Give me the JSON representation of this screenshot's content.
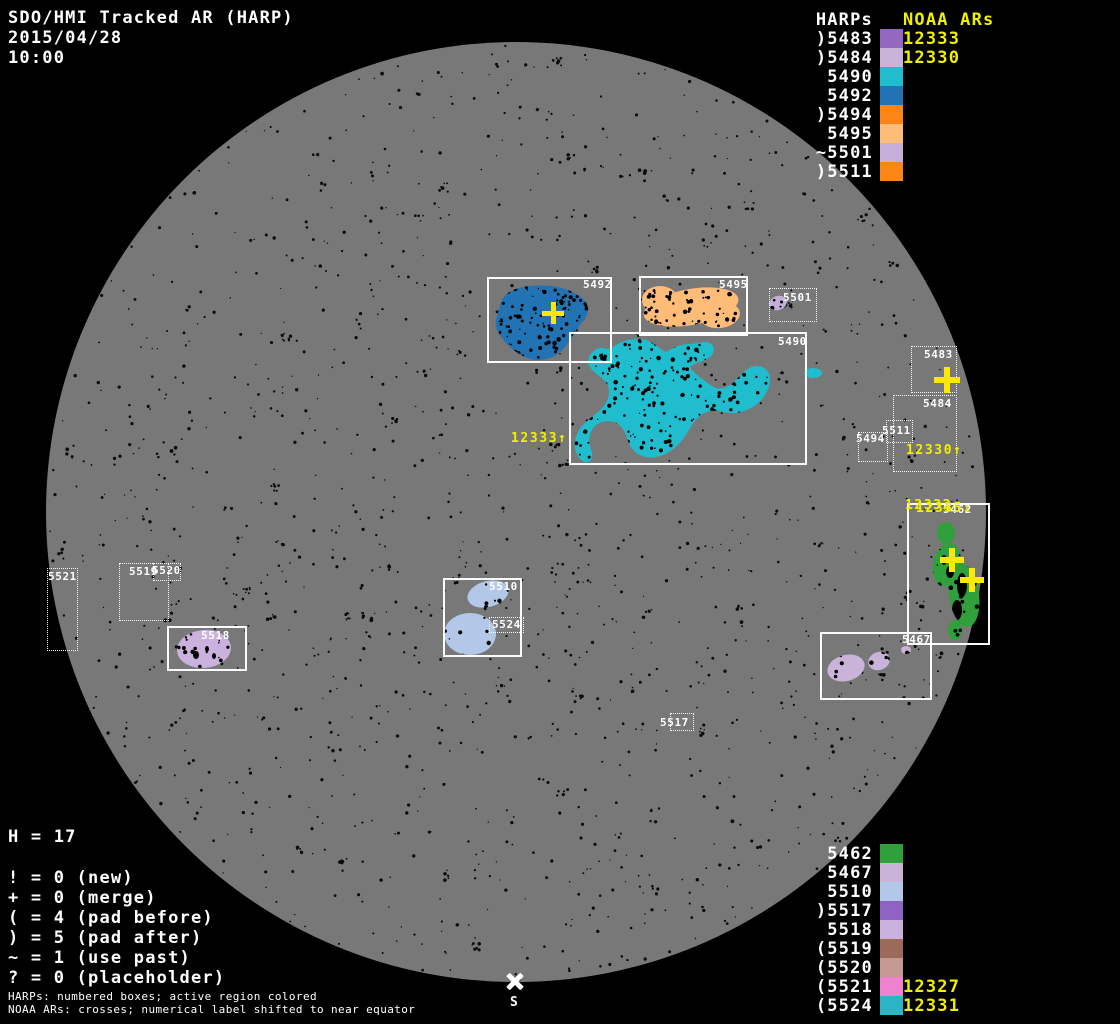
{
  "header": {
    "title": "SDO/HMI Tracked AR (HARP)",
    "date": "2015/04/28",
    "time": "10:00"
  },
  "colors": {
    "background": "#000000",
    "disk": "#787878",
    "speckle": "#0b0b0b",
    "box_border": "#ffffff",
    "white_text": "#ffffff",
    "yellow_text": "#f0f000",
    "cross_yellow": "#ffe70a"
  },
  "legend_top": {
    "noaa_header": "NOAA ARs",
    "harps_header": "HARPs",
    "rows": [
      {
        "noaa": "12333",
        "harp": ")5483",
        "color": "#9468BE"
      },
      {
        "noaa": "12330",
        "harp": ")5484",
        "color": "#C9B3D9"
      },
      {
        "harp": "5490",
        "color": "#1FBDCE"
      },
      {
        "harp": "5492",
        "color": "#2173B4"
      },
      {
        "harp": ")5494",
        "color": "#FB8617"
      },
      {
        "harp": "5495",
        "color": "#FFBB78"
      },
      {
        "harp": "~5501",
        "color": "#C4AFD9"
      },
      {
        "harp": ")5511",
        "color": "#FB8617"
      }
    ]
  },
  "legend_bottom": {
    "rows": [
      {
        "harp": "5462",
        "color": "#2FA03C"
      },
      {
        "harp": "5467",
        "color": "#C9B3D9"
      },
      {
        "harp": "5510",
        "color": "#B3C8E8"
      },
      {
        "harp": ")5517",
        "color": "#8F63C4"
      },
      {
        "harp": "5518",
        "color": "#CBB2DE"
      },
      {
        "harp": "(5519",
        "color": "#9C6A58"
      },
      {
        "harp": "(5520",
        "color": "#C59A92"
      },
      {
        "noaa": "12327",
        "harp": "(5521",
        "color": "#EE82CE"
      },
      {
        "noaa": "12331",
        "harp": "(5524",
        "color": "#2AB6C5"
      }
    ]
  },
  "stats": {
    "h_line": "H = 17",
    "lines": [
      "! = 0 (new)",
      "+ = 0 (merge)",
      "( = 4 (pad before)",
      ") = 5 (pad after)",
      "~ = 1 (use past)",
      "? = 0 (placeholder)"
    ]
  },
  "footnotes": {
    "line1": "HARPs: numbered boxes; active region colored",
    "line2": "NOAA ARs: crosses; numerical label shifted to near equator"
  },
  "south_marker": {
    "label": "S",
    "x": 515,
    "y": 981
  },
  "disk": {
    "cx": 516,
    "cy": 512,
    "r": 470
  },
  "boxes": [
    {
      "id": "5492",
      "x": 487,
      "y": 277,
      "w": 125,
      "h": 86,
      "style": "solid",
      "label": "5492",
      "lx": 583,
      "ly": 278
    },
    {
      "id": "5495",
      "x": 639,
      "y": 276,
      "w": 109,
      "h": 60,
      "style": "solid",
      "label": "5495",
      "lx": 719,
      "ly": 278
    },
    {
      "id": "5490",
      "x": 569,
      "y": 332,
      "w": 238,
      "h": 133,
      "style": "solid",
      "label": "5490",
      "lx": 778,
      "ly": 335
    },
    {
      "id": "5462",
      "x": 907,
      "y": 503,
      "w": 83,
      "h": 142,
      "style": "solid",
      "label": "5462",
      "lx": 943,
      "ly": 503
    },
    {
      "id": "5467",
      "x": 820,
      "y": 632,
      "w": 112,
      "h": 68,
      "style": "solid",
      "label": "5467",
      "lx": 902,
      "ly": 633
    },
    {
      "id": "5518",
      "x": 167,
      "y": 626,
      "w": 80,
      "h": 45,
      "style": "solid",
      "label": "5518",
      "lx": 201,
      "ly": 629
    },
    {
      "id": "5510",
      "x": 443,
      "y": 578,
      "w": 79,
      "h": 79,
      "style": "solid",
      "label": "5510",
      "lx": 489,
      "ly": 580
    },
    {
      "id": "5501",
      "x": 769,
      "y": 288,
      "w": 48,
      "h": 34,
      "style": "dashed",
      "label": "5501",
      "lx": 783,
      "ly": 291
    },
    {
      "id": "5483",
      "x": 911,
      "y": 346,
      "w": 46,
      "h": 47,
      "style": "dashed",
      "label": "5483",
      "lx": 924,
      "ly": 348
    },
    {
      "id": "5484",
      "x": 893,
      "y": 395,
      "w": 64,
      "h": 77,
      "style": "dashed",
      "label": "5484",
      "lx": 923,
      "ly": 397
    },
    {
      "id": "5511",
      "x": 886,
      "y": 420,
      "w": 27,
      "h": 23,
      "style": "dashed",
      "label": "5511",
      "lx": 882,
      "ly": 424
    },
    {
      "id": "5494",
      "x": 858,
      "y": 432,
      "w": 30,
      "h": 30,
      "style": "dashed",
      "label": "5494",
      "lx": 856,
      "ly": 432
    },
    {
      "id": "5521",
      "x": 47,
      "y": 568,
      "w": 31,
      "h": 83,
      "style": "dashed",
      "label": "5521",
      "lx": 48,
      "ly": 570
    },
    {
      "id": "5519",
      "x": 119,
      "y": 563,
      "w": 50,
      "h": 58,
      "style": "dashed",
      "label": "5519",
      "lx": 129,
      "ly": 565
    },
    {
      "id": "5520",
      "x": 153,
      "y": 563,
      "w": 28,
      "h": 18,
      "style": "dashed",
      "label": "5520",
      "lx": 152,
      "ly": 564
    },
    {
      "id": "5517",
      "x": 670,
      "y": 713,
      "w": 24,
      "h": 18,
      "style": "dashed",
      "label": "5517",
      "lx": 660,
      "ly": 716
    },
    {
      "id": "5524",
      "x": 489,
      "y": 617,
      "w": 35,
      "h": 16,
      "style": "dashed",
      "label": "5524",
      "lx": 492,
      "ly": 618
    }
  ],
  "disk_labels": [
    {
      "text": "12333↑",
      "x": 511,
      "y": 431
    },
    {
      "text": "12330↑",
      "x": 906,
      "y": 443
    },
    {
      "text": "12332",
      "x": 905,
      "y": 498
    },
    {
      "text": "12335↓",
      "x": 916,
      "y": 501
    }
  ],
  "crosses": [
    {
      "x": 553,
      "y": 313,
      "s": 22,
      "t": 5
    },
    {
      "x": 947,
      "y": 380,
      "s": 26,
      "t": 6
    },
    {
      "x": 952,
      "y": 560,
      "s": 24,
      "t": 6
    },
    {
      "x": 972,
      "y": 580,
      "s": 24,
      "t": 6
    }
  ],
  "regions": [
    {
      "id": "5492",
      "color": "#2173B4",
      "speckles": 130,
      "bbox": [
        492,
        286,
        100,
        74
      ],
      "shapes": [
        {
          "type": "path",
          "d": "M 500 305 C 502 295 512 289 523 287 C 538 284 555 285 568 290 C 578 294 587 300 588 308 C 589 316 582 322 577 329 C 570 339 566 349 556 355 C 546 361 533 362 523 356 C 512 350 502 341 497 330 C 493 322 499 313 500 305 Z"
        }
      ]
    },
    {
      "id": "5495",
      "color": "#FFBB78",
      "speckles": 70,
      "bbox": [
        645,
        288,
        95,
        40
      ],
      "shapes": [
        {
          "type": "ellipse",
          "cx": 691,
          "cy": 307,
          "rx": 48,
          "ry": 18,
          "rot": -10
        },
        {
          "type": "ellipse",
          "cx": 660,
          "cy": 300,
          "rx": 18,
          "ry": 14,
          "rot": 0
        },
        {
          "type": "ellipse",
          "cx": 720,
          "cy": 315,
          "rx": 20,
          "ry": 13,
          "rot": -8
        }
      ]
    },
    {
      "id": "5501",
      "color": "#C4AFD9",
      "speckles": 5,
      "bbox": [
        769,
        295,
        20,
        16
      ],
      "shapes": [
        {
          "type": "ellipse",
          "cx": 778,
          "cy": 303,
          "rx": 9,
          "ry": 7,
          "rot": -20
        }
      ]
    },
    {
      "id": "5490",
      "color": "#1FBDCE",
      "speckles": 300,
      "bbox": [
        575,
        340,
        200,
        122
      ],
      "shapes": [
        {
          "type": "path",
          "d": "M 612 348 C 620 341 634 337 646 340 C 654 342 659 349 666 352 C 674 347 682 344 690 344 C 697 344 704 340 710 343 C 715 346 715 353 710 357 C 704 362 695 362 690 367 C 695 375 704 380 712 386 C 719 391 727 388 734 382 C 741 375 748 366 757 366 C 765 366 771 373 770 381 C 769 392 762 401 753 407 C 744 412 733 415 724 412 C 716 410 708 410 701 415 C 693 421 689 431 683 439 C 676 448 667 455 656 457 C 646 459 636 455 631 447 C 626 439 626 429 618 424 C 610 419 600 421 594 427 C 589 433 588 442 591 449 C 593 455 593 461 588 462 C 583 463 578 458 576 452 C 573 443 576 433 582 426 C 588 419 597 414 603 407 C 609 400 611 391 607 384 C 603 377 594 374 590 367 C 586 360 590 352 597 349 C 603 346 607 351 612 348 Z"
        },
        {
          "type": "ellipse",
          "cx": 813,
          "cy": 373,
          "rx": 9,
          "ry": 5,
          "rot": 0
        }
      ]
    },
    {
      "id": "5462",
      "color": "#2FA03C",
      "speckles": 50,
      "bbox": [
        930,
        520,
        55,
        115
      ],
      "shapes": [
        {
          "type": "ellipse",
          "cx": 946,
          "cy": 533,
          "rx": 9,
          "ry": 11,
          "rot": 0
        },
        {
          "type": "ellipse",
          "cx": 947,
          "cy": 565,
          "rx": 14,
          "ry": 22,
          "rot": 10
        },
        {
          "type": "ellipse",
          "cx": 964,
          "cy": 595,
          "rx": 15,
          "ry": 32,
          "rot": -8
        },
        {
          "type": "ellipse",
          "cx": 955,
          "cy": 630,
          "rx": 7,
          "ry": 10,
          "rot": 0
        }
      ],
      "dark": [
        {
          "cx": 962,
          "cy": 585,
          "rx": 5,
          "ry": 12
        },
        {
          "cx": 957,
          "cy": 610,
          "rx": 5,
          "ry": 10
        },
        {
          "cx": 950,
          "cy": 572,
          "rx": 4,
          "ry": 6
        },
        {
          "cx": 944,
          "cy": 560,
          "rx": 3,
          "ry": 5
        }
      ]
    },
    {
      "id": "5467",
      "color": "#C9B3D9",
      "speckles": 20,
      "bbox": [
        826,
        648,
        85,
        30
      ],
      "shapes": [
        {
          "type": "ellipse",
          "cx": 846,
          "cy": 668,
          "rx": 19,
          "ry": 13,
          "rot": -15
        },
        {
          "type": "ellipse",
          "cx": 879,
          "cy": 661,
          "rx": 11,
          "ry": 9,
          "rot": -20
        },
        {
          "type": "ellipse",
          "cx": 906,
          "cy": 650,
          "rx": 5,
          "ry": 4,
          "rot": 0
        }
      ]
    },
    {
      "id": "5518",
      "color": "#CBB2DE",
      "speckles": 18,
      "bbox": [
        178,
        632,
        55,
        38
      ],
      "shapes": [
        {
          "type": "ellipse",
          "cx": 204,
          "cy": 649,
          "rx": 27,
          "ry": 19,
          "rot": -5
        }
      ],
      "dark": [
        {
          "cx": 196,
          "cy": 655,
          "rx": 3,
          "ry": 4
        },
        {
          "cx": 207,
          "cy": 649,
          "rx": 2,
          "ry": 3
        },
        {
          "cx": 214,
          "cy": 656,
          "rx": 2,
          "ry": 3
        }
      ]
    },
    {
      "id": "5510",
      "color": "#B3C8E8",
      "speckles": 30,
      "bbox": [
        445,
        580,
        70,
        75
      ],
      "shapes": [
        {
          "type": "ellipse",
          "cx": 488,
          "cy": 594,
          "rx": 21,
          "ry": 13,
          "rot": -15
        },
        {
          "type": "ellipse",
          "cx": 470,
          "cy": 634,
          "rx": 26,
          "ry": 21,
          "rot": 0
        }
      ]
    }
  ]
}
